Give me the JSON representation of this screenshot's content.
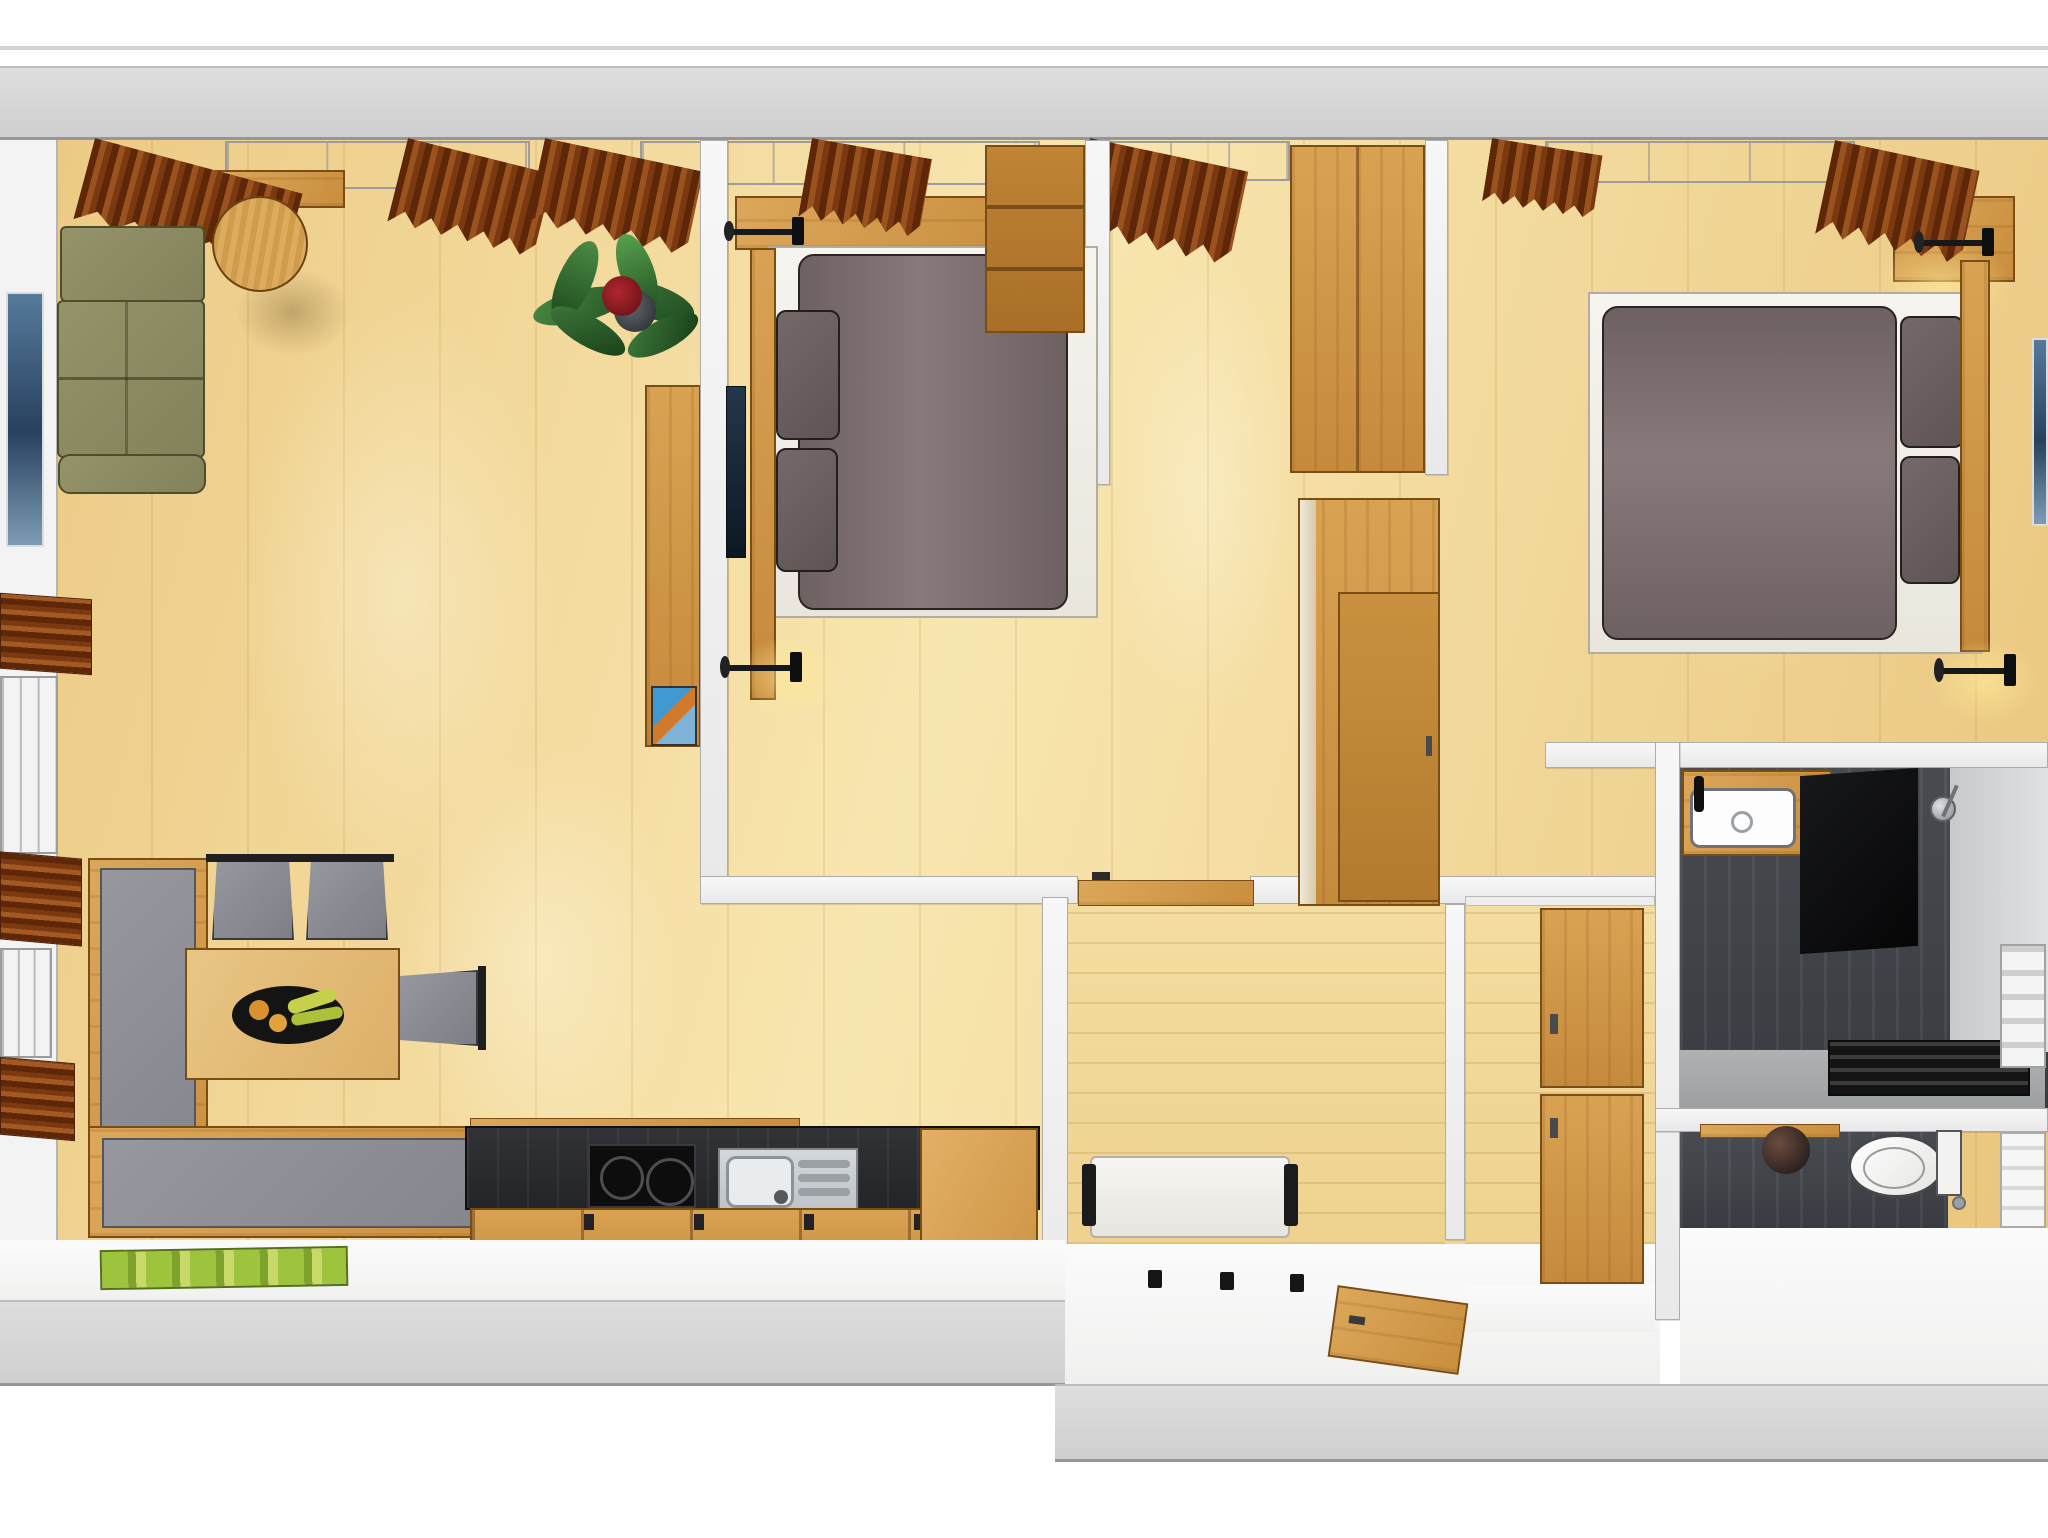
{
  "meta": {
    "title": "Top-down 3D rendering of an apartment floor plan",
    "render_type": "architectural visualization, no visible text or UI controls"
  },
  "palette": {
    "floor_wood": "#eecd87",
    "floor_hall": "#f2d898",
    "furniture_wood": "#d0984a",
    "outer_wall": "#d5d5d5",
    "inner_wall": "#f4f4f4",
    "curtain_brown": "#7a3911",
    "sofa_olive": "#8d8b61",
    "upholstery_grey": "#8d8d96",
    "bedding_taupe": "#7b6d6e",
    "bath_charcoal": "#43464b",
    "accent_plant": "#3f7a3c",
    "accent_mat_green": "#9ec43e",
    "counter_black": "#2c2d30",
    "stainless": "#ccd0d3"
  },
  "rooms": {
    "living": {
      "label": "Living and dining room"
    },
    "kitchen": {
      "label": "Kitchenette"
    },
    "bedroom1": {
      "label": "Bedroom 1"
    },
    "bedroom2": {
      "label": "Bedroom 2"
    },
    "nook": {
      "label": "Dressing nook between bedrooms"
    },
    "hall": {
      "label": "Entrance hall"
    },
    "corridor": {
      "label": "Closet corridor"
    },
    "bathroom": {
      "label": "Shower bathroom"
    },
    "wc": {
      "label": "Separate WC"
    }
  },
  "furniture": {
    "sofa": {
      "label": "Olive green corner sofa"
    },
    "coffee_table": {
      "label": "Round wooden coffee table"
    },
    "plant": {
      "label": "Potted green plant"
    },
    "tv_board": {
      "label": "Wooden media sideboard with decor object"
    },
    "picture_left": {
      "label": "Blue wall picture (living room)"
    },
    "picture_right": {
      "label": "Blue wall picture (bedroom 2)"
    },
    "dining_bench": {
      "label": "L-shaped corner bench with grey cushions"
    },
    "dining_table": {
      "label": "Wooden dining table with fruit bowl"
    },
    "chairs": {
      "label": "Grey dining chairs"
    },
    "kitchen_counter": {
      "label": "Dark kitchen worktop"
    },
    "cooktop": {
      "label": "Two-zone cooktop"
    },
    "sink": {
      "label": "Stainless sink with drainer"
    },
    "cabinets": {
      "label": "Wooden kitchen base cabinets"
    },
    "bed1": {
      "label": "Double bed bedroom 1 with taupe bedding"
    },
    "bed2": {
      "label": "Double bed bedroom 2 with taupe bedding"
    },
    "reading_lamps": {
      "label": "Black wall reading lamps"
    },
    "wardrobes": {
      "label": "Built-in wooden wardrobes"
    },
    "hall_bench": {
      "label": "White hall bench"
    },
    "coat_hooks": {
      "label": "Black coat hooks"
    },
    "entry_door": {
      "label": "Wooden entrance door (open)"
    },
    "room_door": {
      "label": "Wooden room door (open)"
    },
    "green_mat": {
      "label": "Green doormat"
    },
    "vanity": {
      "label": "Wash basin on wooden vanity"
    },
    "shower": {
      "label": "Walk-in shower with dark tiles and drain grille"
    },
    "radiator": {
      "label": "Towel radiator"
    },
    "toilet": {
      "label": "Toilet with cistern"
    },
    "pendant": {
      "label": "Dark pendant lamp"
    }
  }
}
